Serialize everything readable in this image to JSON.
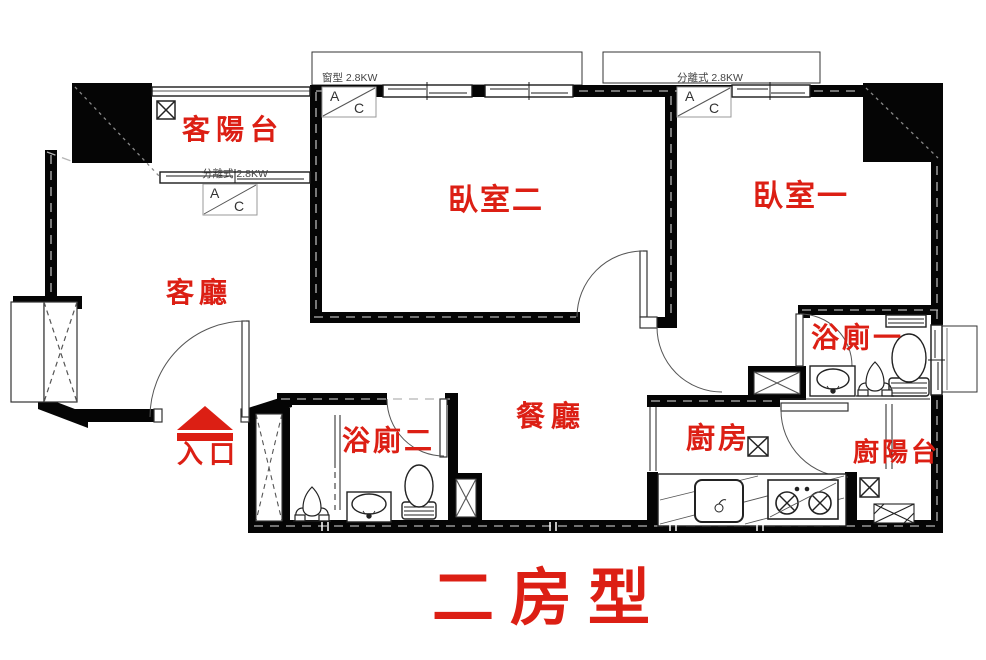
{
  "title": {
    "text": "二房型"
  },
  "colors": {
    "label_red": "#dc1f14",
    "wall_black": "#050505"
  },
  "rooms": {
    "living_balcony": {
      "label": "客陽台"
    },
    "living_room": {
      "label": "客廳"
    },
    "bedroom_2": {
      "label": "臥室二"
    },
    "bedroom_1": {
      "label": "臥室一"
    },
    "bath_2": {
      "label": "浴廁二"
    },
    "bath_1": {
      "label": "浴廁一"
    },
    "dining": {
      "label": "餐廳"
    },
    "kitchen": {
      "label": "廚房"
    },
    "kitchen_balcony": {
      "label": "廚陽台"
    }
  },
  "entrance": {
    "label": "入口"
  },
  "ac": {
    "balcony_unit": {
      "label": "分離式 2.8KW"
    },
    "bedroom2_unit": {
      "label": "窗型 2.8KW"
    },
    "bedroom1_unit": {
      "label": "分離式 2.8KW"
    },
    "box_a": "A",
    "box_c": "C"
  }
}
